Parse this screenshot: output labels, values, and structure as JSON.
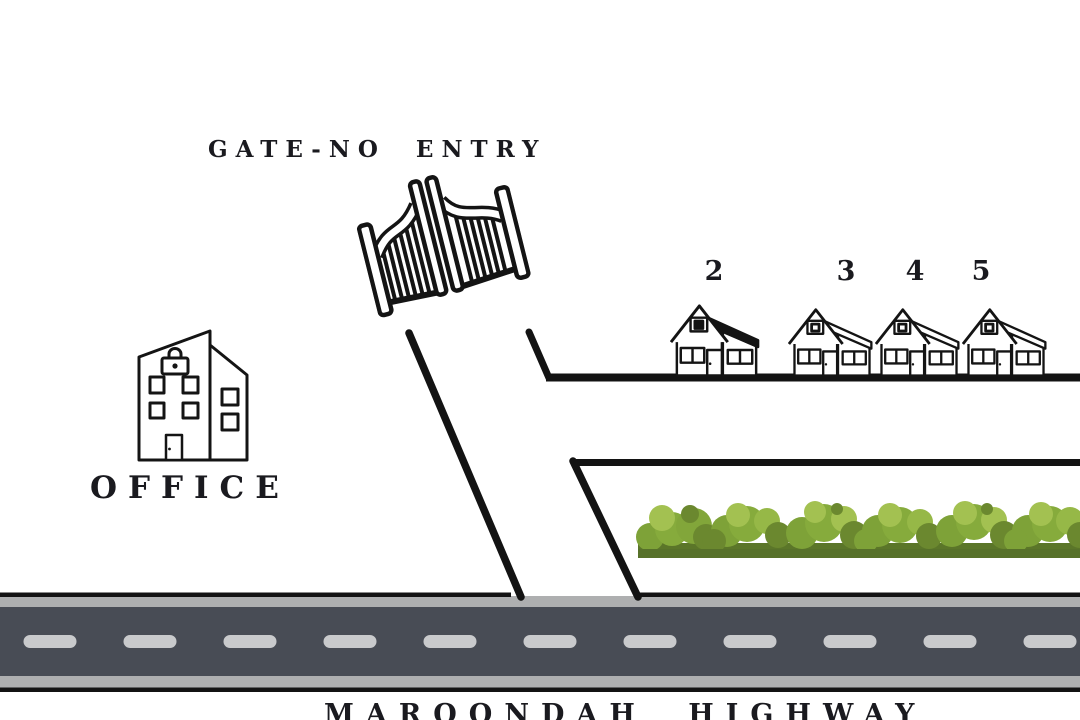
{
  "title": "Site map - gate, office, houses and Maroondah Highway",
  "labels": {
    "gate": "GATE-NO ENTRY",
    "office": "OFFICE",
    "highway": "MAROONDAH HIGHWAY"
  },
  "houses": [
    {
      "number": "2",
      "variant": "dark-roof"
    },
    {
      "number": "3",
      "variant": "outline"
    },
    {
      "number": "4",
      "variant": "outline"
    },
    {
      "number": "5",
      "variant": "outline"
    }
  ],
  "icons": {
    "gate": "gate-icon",
    "office": "office-building-icon",
    "house": "house-icon",
    "hedge": "hedge-icon"
  },
  "colors": {
    "ink": "#141414",
    "text": "#1a1a1f",
    "road_asphalt": "#484c55",
    "road_shoulder": "#aeafb0",
    "road_dash": "#c9cacc",
    "road_edge": "#131313",
    "bush_light": "#a3c151",
    "bush_mid": "#82a63a",
    "bush_dark": "#6b882f",
    "bush_base": "#5b7629",
    "dark_roof": "#141414"
  }
}
